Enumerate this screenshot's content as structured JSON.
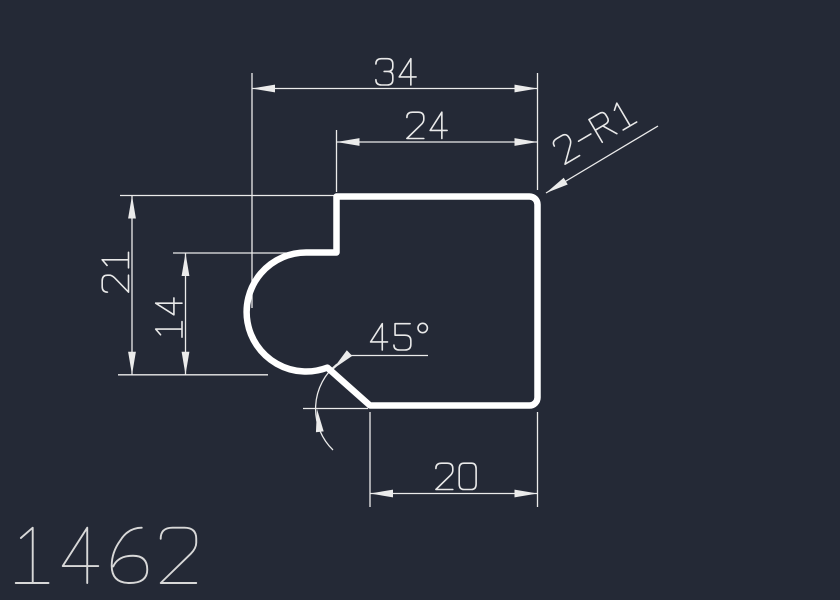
{
  "drawing_area": {
    "background": "#242936",
    "outline_color": "#ffffff",
    "annotation_color": "#ebebeb",
    "text_color": "#e9e9e9",
    "part_number_color": "#d8d8d8"
  },
  "annotations": {
    "overall_width": "34",
    "upper_width": "24",
    "left_height": "21",
    "pocket_height": "14",
    "bottom_width": "20",
    "chamfer_angle": "45°",
    "fillet_note": "2-R1"
  },
  "part_number": "1462"
}
